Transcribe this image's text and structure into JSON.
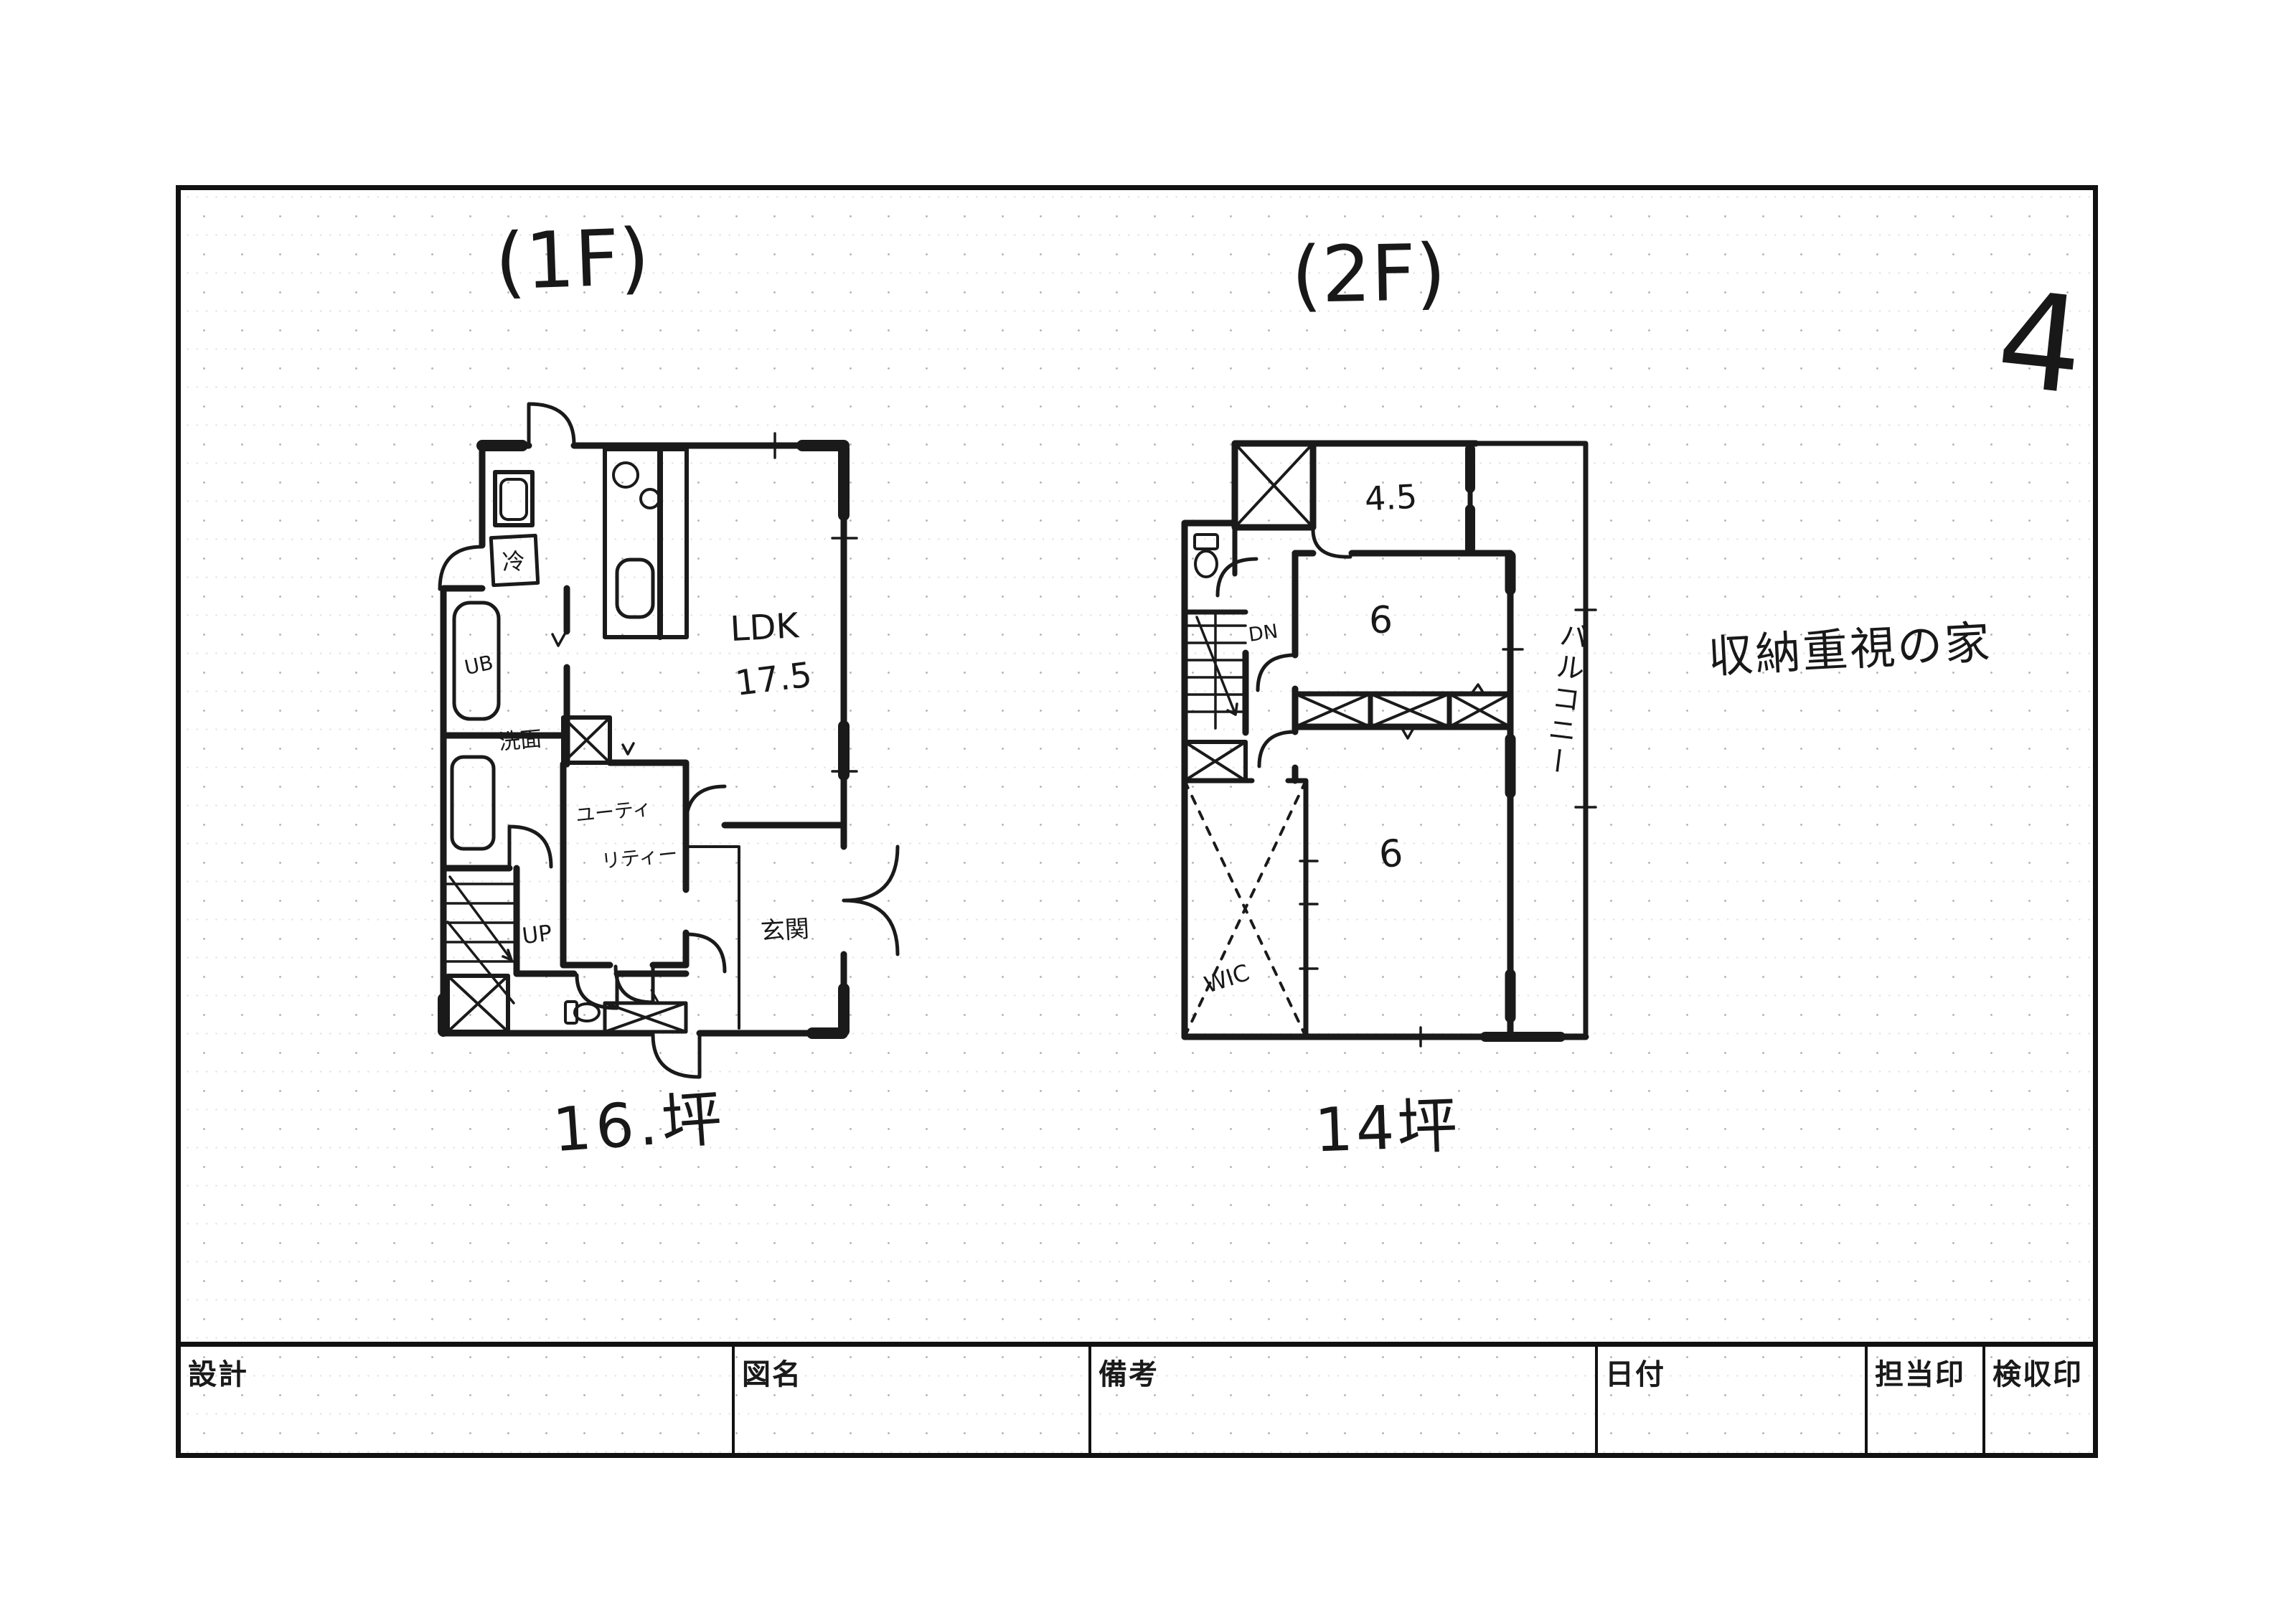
{
  "annotations": {
    "page_number": "4",
    "concept_note": "収納重視の家"
  },
  "plan1f": {
    "title": "(1F)",
    "area_label": "16.坪",
    "ldk": "LDK",
    "ldk_value": "17.5",
    "fridge": "冷",
    "unit_bath": "UB",
    "washroom": "洗面",
    "utility_line1": "ユーティ",
    "utility_line2": "リティー",
    "up": "UP",
    "entrance": "玄関"
  },
  "plan2f": {
    "title": "(2F)",
    "area_label": "14坪",
    "room_45": "4.5",
    "room_6_mid": "6",
    "room_6_low": "6",
    "down": "DN",
    "wic": "WIC",
    "balcony": "バルコニー"
  },
  "title_block": {
    "design": "設計",
    "drawing_name": "図名",
    "remarks": "備考",
    "date": "日付",
    "staff_seal": "担当印",
    "inspection_seal": "検収印"
  },
  "colors": {
    "ink": "#1a1a1a",
    "paper": "#ffffff",
    "grid_dot": "#8a8f98"
  }
}
